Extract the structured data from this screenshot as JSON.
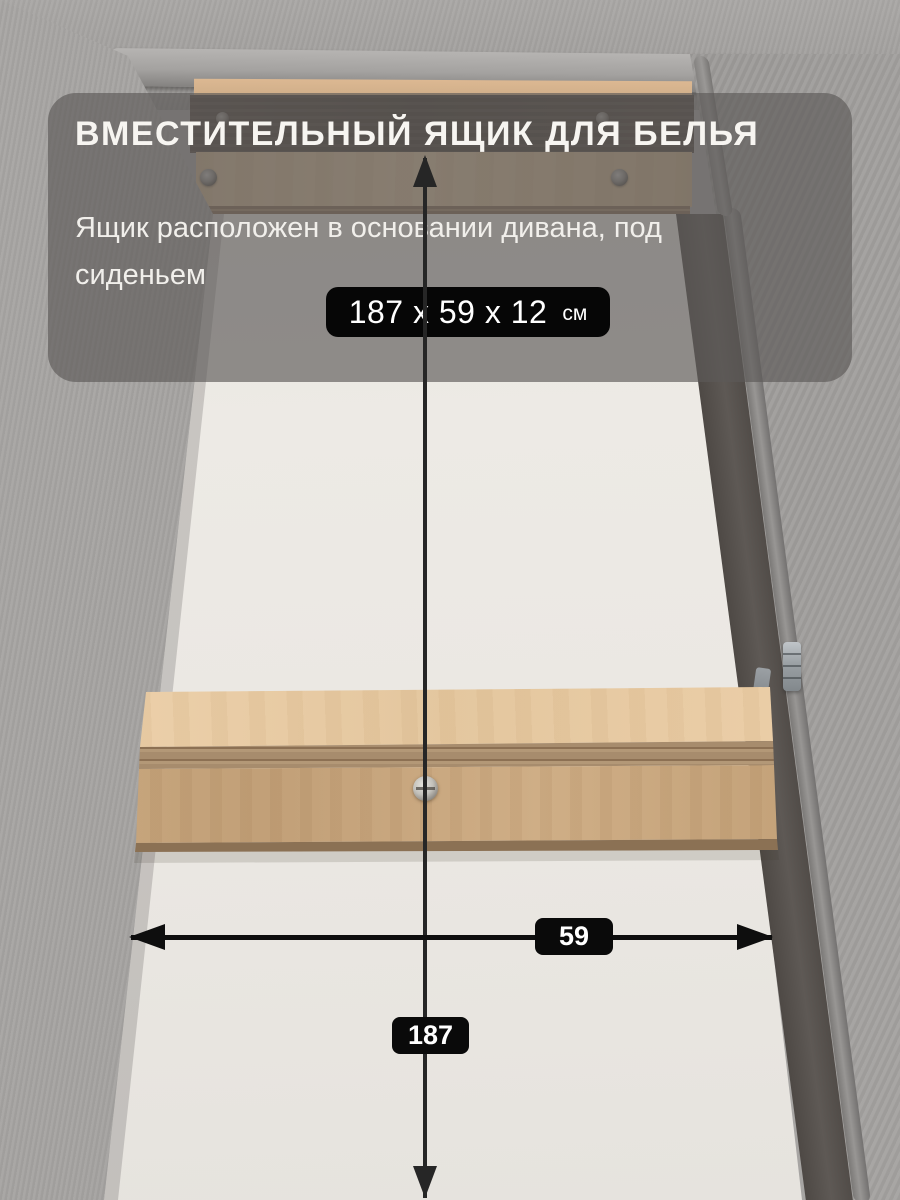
{
  "overlay": {
    "title": "ВМЕСТИТЕЛЬНЫЙ ЯЩИК ДЛЯ БЕЛЬЯ",
    "subtitle": "Ящик расположен в основании дивана, под сиденьем",
    "dimensions": {
      "value": "187 х 59 х 12",
      "unit": "см"
    }
  },
  "annotations": {
    "width_label": "59",
    "length_label": "187"
  },
  "colors": {
    "panel_overlay": "#5c5a58",
    "badge_background": "#0a0a0a",
    "text": "#f5f3ef",
    "arrow": "#1a1a1a",
    "fabric_gray": "#a09e9c",
    "drawer_bottom_white": "#eae7e2",
    "wood_light": "#e8cda7",
    "wood_medium": "#c8a77e",
    "wood_dark_board": "#4e443c"
  }
}
